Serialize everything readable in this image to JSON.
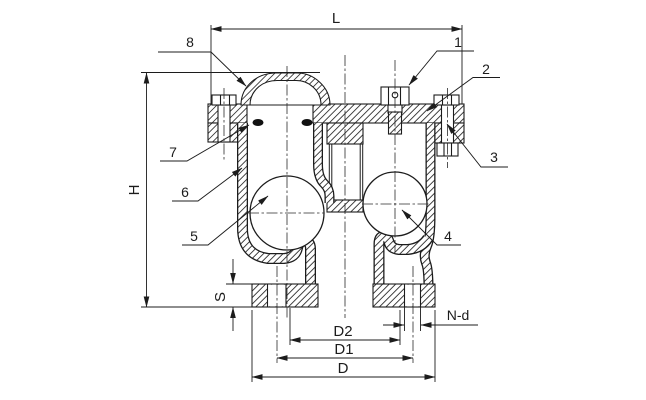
{
  "drawing": {
    "dimension_labels": {
      "L": "L",
      "H": "H",
      "S": "S",
      "D2": "D2",
      "D1": "D1",
      "D": "D",
      "Nd": "N-d"
    },
    "part_callouts": {
      "p1": "1",
      "p2": "2",
      "p3": "3",
      "p4": "4",
      "p5": "5",
      "p6": "6",
      "p7": "7",
      "p8": "8"
    },
    "colors": {
      "line": "#1c1c1c",
      "background": "#ffffff",
      "seal": "#111111"
    }
  }
}
